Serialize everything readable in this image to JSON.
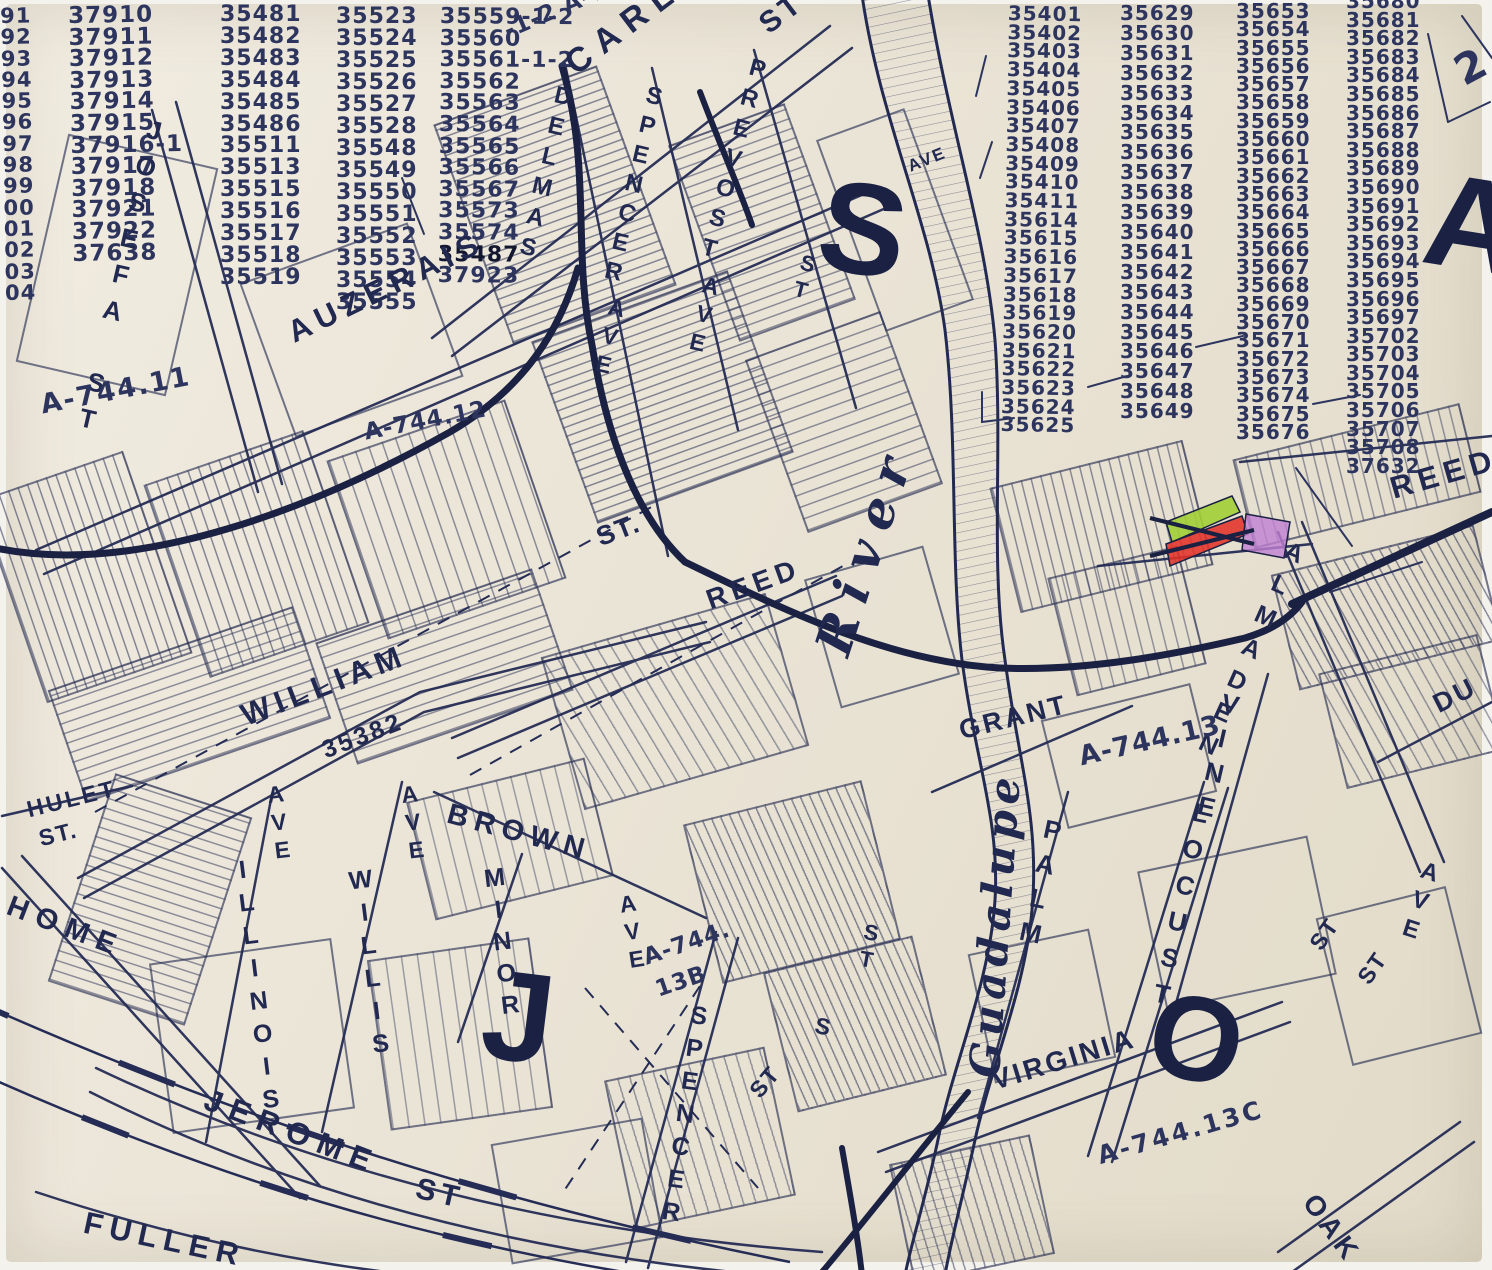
{
  "map": {
    "colors": {
      "paper": "#eae4d6",
      "ink": "#232a52",
      "parcel_green": "#a2cf35",
      "parcel_red": "#e23128",
      "parcel_purple": "#c17fd2"
    },
    "number_columns": {
      "c1": [
        "91",
        "92",
        "93",
        "94",
        "95",
        "96",
        "97",
        "98",
        "99",
        "00",
        "01",
        "02",
        "03",
        "04"
      ],
      "c2": [
        "37910",
        "37911",
        "37912",
        "37913",
        "37914",
        "37915",
        "37916-1",
        "37917",
        "37918",
        "37921",
        "37922",
        "37638"
      ],
      "c3": [
        "35481",
        "35482",
        "35483",
        "35484",
        "35485",
        "35486",
        "35511",
        "35513",
        "35515",
        "35516",
        "35517",
        "35518",
        "35519"
      ],
      "c4": [
        "35523",
        "35524",
        "35525",
        "35526",
        "35527",
        "35528",
        "35548",
        "35549",
        "35550",
        "35551",
        "35552",
        "35553",
        "35554",
        "35555"
      ],
      "c5": [
        "35559-1-2",
        "35560",
        "35561-1-2",
        "35562",
        "35563",
        "35564",
        "35565",
        "35566",
        "35567",
        "35573",
        "35574",
        "35487",
        "37923"
      ],
      "c6": [
        "35401",
        "35402",
        "35403",
        "35404",
        "35405",
        "35406",
        "35407",
        "35408",
        "35409",
        "35410",
        "35411",
        "35614",
        "35615",
        "35616",
        "35617",
        "35618",
        "35619",
        "35620",
        "35621",
        "35622",
        "35623",
        "35624",
        "35625"
      ],
      "c7": [
        "35629",
        "35630",
        "35631",
        "35632",
        "35633",
        "35634",
        "35635",
        "35636",
        "35637",
        "35638",
        "35639",
        "35640",
        "35641",
        "35642",
        "35643",
        "35644",
        "35645",
        "35646",
        "35647",
        "35648",
        "35649"
      ],
      "c8": [
        "35653",
        "35654",
        "35655",
        "35656",
        "35657",
        "35658",
        "35659",
        "35660",
        "35661",
        "35662",
        "35663",
        "35664",
        "35665",
        "35666",
        "35667",
        "35668",
        "35669",
        "35670",
        "35671",
        "35672",
        "35673",
        "35674",
        "35675",
        "35676"
      ],
      "c9": [
        "35680",
        "35681",
        "35682",
        "35683",
        "35684",
        "35685",
        "35686",
        "35687",
        "35688",
        "35689",
        "35690",
        "35691",
        "35692",
        "35693",
        "35694",
        "35695",
        "35696",
        "35697",
        "35702",
        "35703",
        "35704",
        "35705",
        "35706",
        "35707",
        "35708",
        "37632"
      ]
    },
    "labels": {
      "carlos": "CARLOS",
      "carlos_st": "ST",
      "josefa": "JOSEFA ST",
      "auzerais": "AUZERAIS",
      "delmas": "DELMAS",
      "delmas_ave": "AVE",
      "spencer_top": "SPENCER",
      "spencer_top_ave": "AVE",
      "prevost": "PREVOST",
      "prevost_st": "ST",
      "river_ave": "AVE",
      "river": "River",
      "guadalupe": "Guadalupe",
      "reed_center_st": "ST.",
      "reed_center": "REED",
      "william": "WILLIAM",
      "william_num": "35382",
      "hulet": "HULET",
      "hulet_st": "ST.",
      "home": "HOME",
      "home_ave": "AVE",
      "illinois": "ILLINOIS",
      "illinois_ave": "AVE",
      "willis": "WILLIS",
      "willis_ave": "AVE",
      "minor": "MINOR",
      "minor_ave": "AVE",
      "brown": "BROWN",
      "jerome": "JEROME",
      "jerome_st": "ST",
      "fuller": "FULLER",
      "spencer_bottom": "SPENCER",
      "spencer_bottom_st": "ST",
      "grant": "GRANT",
      "palm": "PALM",
      "locust": "LOCUST",
      "vine": "VINE",
      "almaden": "ALMADEN",
      "reed_topright": "REED",
      "du": "DU",
      "right_ave": "AVE",
      "virginia": "VIRGINIA",
      "oak": "OAK",
      "st_small_1": "ST",
      "st_small_2": "ST",
      "st_center": "ST",
      "s_single": "S"
    },
    "tracts": {
      "a_744_11": "A-744.11",
      "a_744_12": "A-744.12",
      "a_744_13": "A-744.13",
      "a_744_13b_line1": "A-744.",
      "a_744_13b_line2": "13B",
      "a_744_13c": "A-744.13C",
      "a_744_15": "-1-2  A-744.15"
    },
    "big_letters": {
      "s": "S",
      "j": "J",
      "o": "O",
      "a": "A"
    },
    "annotations": {
      "two": "2"
    }
  }
}
